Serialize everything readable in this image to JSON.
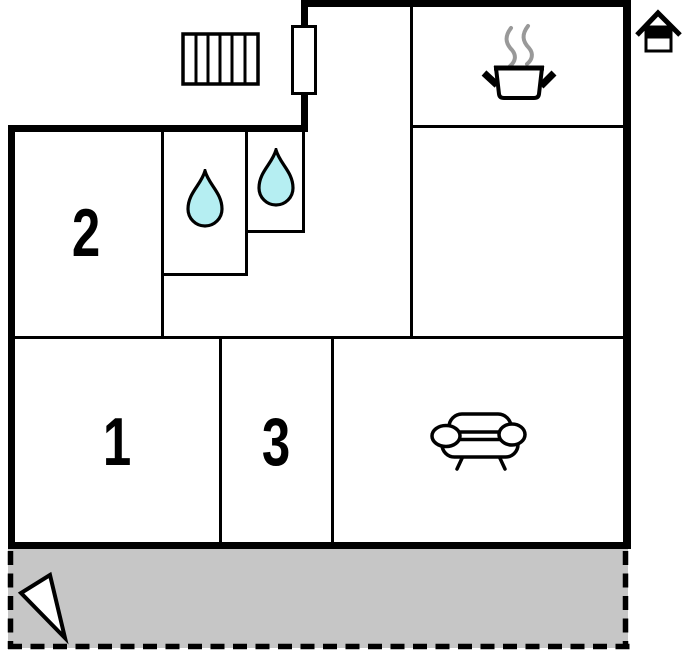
{
  "floorplan": {
    "room_labels": [
      {
        "label": "2"
      },
      {
        "label": "1"
      },
      {
        "label": "3"
      }
    ],
    "icons": {
      "radiator": "radiator-grill-icon",
      "door": "door-icon",
      "cooking_pot": "cooking-pot-icon",
      "steam": "steam-icon",
      "house_logo": "house-logo-icon",
      "water_drop_left": "water-drop-icon",
      "water_drop_right": "water-drop-icon",
      "sofa": "sofa-icon",
      "north_arrow": "north-arrow-icon"
    },
    "colors": {
      "wall": "#000000",
      "background": "#ffffff",
      "water_drop_fill": "#b5eef2",
      "terrace_fill": "#c6c6c6",
      "steam_gray": "#999999"
    }
  }
}
